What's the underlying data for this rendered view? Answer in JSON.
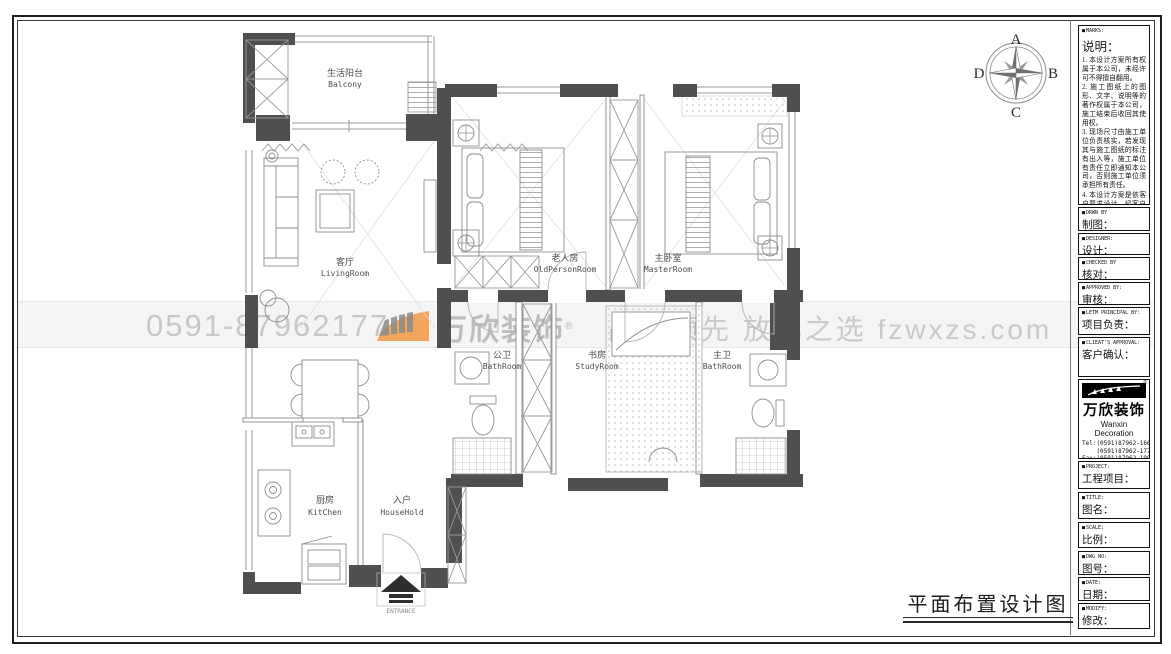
{
  "sheet": {
    "title": "平面布置设计图",
    "compass": {
      "top": "A",
      "right": "B",
      "bottom": "C",
      "left": "D"
    },
    "watermark": {
      "phone": "0591-87962177",
      "brand": "万欣装饰",
      "reg": "®",
      "slogan": "品质领先 放心之选 fzwxzs.com"
    },
    "colors": {
      "accent_orange": "#f2a55d",
      "wall_gray": "#4f4f4f",
      "watermark_gray": "#c8c8c8"
    }
  },
  "plan": {
    "rooms": [
      {
        "cn": "生活阳台",
        "en": "Balcony"
      },
      {
        "cn": "客厅",
        "en": "LivingRoom"
      },
      {
        "cn": "老人房",
        "en": "OldPersonRoom"
      },
      {
        "cn": "主卧室",
        "en": "MasterRoom"
      },
      {
        "cn": "公卫",
        "en": "BathRoom"
      },
      {
        "cn": "书房",
        "en": "StudyRoom"
      },
      {
        "cn": "主卫",
        "en": "BathRoom"
      },
      {
        "cn": "厨房",
        "en": "KitChen"
      },
      {
        "cn": "入户",
        "en": "HouseHold"
      }
    ],
    "entrance": "ENTRANCE"
  },
  "titleblock": {
    "marks": {
      "en": "MARKS:",
      "cn": "说明：",
      "notes": [
        "1. 本设计方案所有权属于本公司，未经许可不得擅自翻用。",
        "2. 施工图纸上的图形、文字、说明等的著作权属于本公司，施工结束后收回其使用权。",
        "3. 现场尺寸由施工单位负责核实，若发现其与施工图纸的标注有出入等，施工单位有责任立即通知本公司，否则施工单位须承担所有责任。",
        "4. 本设计方案是依客户要求设计，经客户签字即视为同意认可，不得随意更改。"
      ]
    },
    "fields": [
      {
        "en": "DRWN BY",
        "cn": "制图："
      },
      {
        "en": "DESIGNER:",
        "cn": "设计："
      },
      {
        "en": "CHECKED BY",
        "cn": "核对："
      },
      {
        "en": "APPROVED BY:",
        "cn": "审核："
      },
      {
        "en": "LETM PRINCIPAL BY:",
        "cn": "项目负责："
      },
      {
        "en": "CLIEAT'S APPROVAL:",
        "cn": "客户确认："
      }
    ],
    "company": {
      "logo_text": "万欣装饰",
      "reg": "®",
      "name_en": "Wanxin Decoration",
      "tel1": "Tel:(0591)87962-166",
      "tel2": "    (0591)87962-177",
      "fax": "Fax:(0591)87962-199",
      "web": "Web:WWW.fzwxzs.com"
    },
    "fields2": [
      {
        "en": "PROJECT:",
        "cn": "工程项目："
      },
      {
        "en": "TITLE:",
        "cn": "图名："
      },
      {
        "en": "SCALE:",
        "cn": "比例："
      },
      {
        "en": "DWG NO:",
        "cn": "图号："
      },
      {
        "en": "DATE:",
        "cn": "日期："
      },
      {
        "en": "MODIFY:",
        "cn": "修改："
      }
    ]
  }
}
